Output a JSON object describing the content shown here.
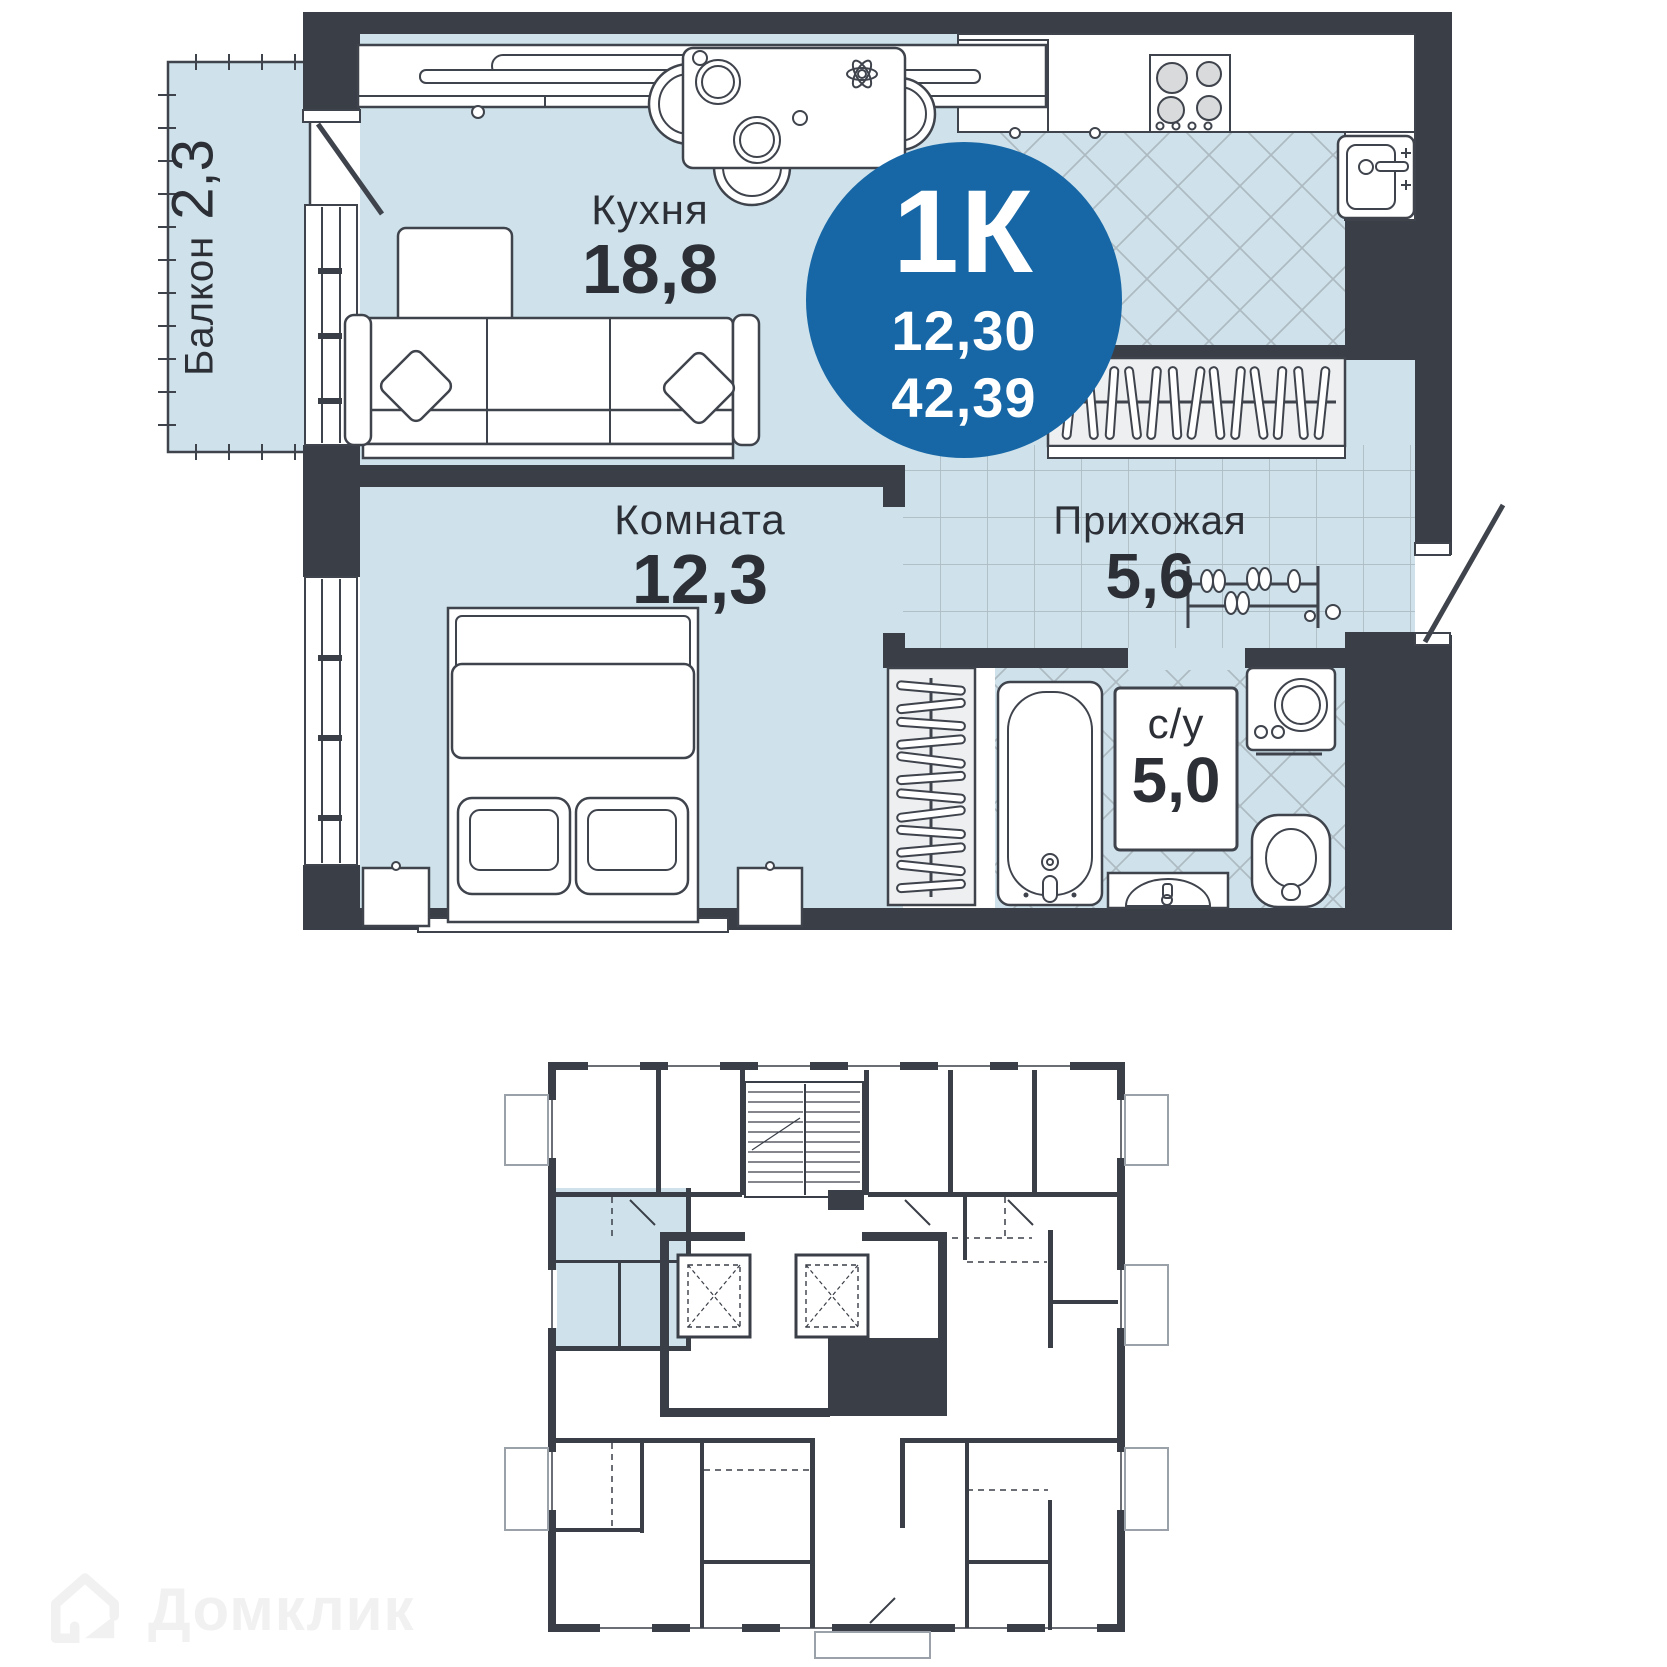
{
  "plan": {
    "rooms": {
      "kitchen": {
        "name": "Кухня",
        "area": "18,8"
      },
      "living": {
        "name": "Комната",
        "area": "12,3"
      },
      "hallway": {
        "name": "Прихожая",
        "area": "5,6"
      },
      "bathroom": {
        "name": "с/у",
        "area": "5,0"
      },
      "balcony": {
        "name": "Балкон",
        "area": "2,3"
      }
    }
  },
  "badge": {
    "rooms_label": "1К",
    "living_area": "12,30",
    "total_area": "42,39"
  },
  "watermark": {
    "brand": "Домклик"
  },
  "icons": {
    "fridge": "snowflake-icon",
    "stove": "burners-icon",
    "elevator": "crossed-box-icon",
    "logo": "domklik-house-icon"
  },
  "colors": {
    "accent_blue": "#1767A6",
    "wall_dark": "#3A3E47",
    "room_fill": "#CFE2EB",
    "tile_line": "#ADBAC1",
    "highlight": "#CFE2EB",
    "watermark": "#F1F1F1"
  }
}
